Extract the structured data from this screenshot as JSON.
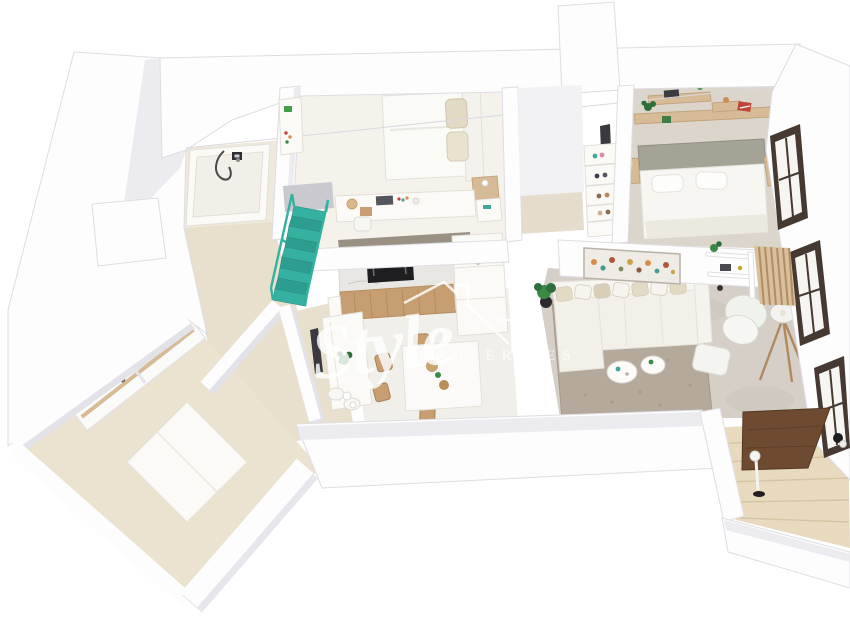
{
  "watermark": {
    "brand": "Style",
    "subtitle": "PROPERTIES",
    "color": "#ffffff",
    "opacity": "0.82"
  },
  "colors": {
    "background": "#ffffff",
    "wall_white": "#fdfdfd",
    "wall_shade": "#e7e7ed",
    "floor_bathroom": "#efe9dc",
    "floor_bedroom1": "#f5f2ec",
    "floor_bedroom2": "#dbd5cc",
    "floor_hall": "#e9dfcd",
    "floor_kitchen": "#e8decd",
    "floor_dining": "#f1efe9",
    "floor_living": "#d5cfc7",
    "floor_storage": "#ece2d0",
    "floor_closet": "#e6dccb",
    "terrace_deck": "#e7dabe",
    "terrace_table_brown": "#6e4a31",
    "rug": "#b5a99b",
    "stairs_teal": "#35b1a2",
    "stairs_teal_dark": "#2c9d8f",
    "wood": "#c79e72",
    "wood_light": "#d7bb96",
    "marble": "#e9e7e3",
    "appliance_black": "#1e1d20",
    "headboard_sage": "#a5a296",
    "sofa_cream": "#f3f0ea",
    "pillow_beige": "#e3dac5",
    "plant_green": "#3a8a46",
    "plant_dark": "#2e6e3a",
    "accent_red": "#c14538",
    "accent_teal": "#3fa79b",
    "accent_orange": "#d98c4a",
    "window_frame": "#453931",
    "door_dark": "#3a3a3e",
    "lamp_glow": "#ffc98e",
    "sign_green": "#43a047"
  },
  "scene": {
    "type": "isometric-3d-floor-plan-render",
    "rooms": [
      {
        "name": "bathroom",
        "items": [
          "bathtub",
          "shower-hose",
          "wall-mixer"
        ]
      },
      {
        "name": "bedroom-1",
        "items": [
          "double-bed",
          "beige-pillows",
          "headboard",
          "nightstand",
          "desk",
          "desk-accessories",
          "desk-chair",
          "hall-cabinet"
        ]
      },
      {
        "name": "hall-closet",
        "items": [
          "built-in-wardrobe",
          "shoe-shelf",
          "entry-door"
        ]
      },
      {
        "name": "bedroom-2",
        "items": [
          "double-bed",
          "sage-headboard",
          "white-pillows",
          "bedside-tables",
          "glowing-lamps",
          "floating-wood-shelves",
          "books",
          "plants"
        ]
      },
      {
        "name": "kitchen",
        "items": [
          "marble-backsplash",
          "built-in-oven",
          "wood-base-cabinets",
          "tall-units",
          "counter-plant",
          "peninsula",
          "bar-stools"
        ]
      },
      {
        "name": "dining-area",
        "items": [
          "dining-table",
          "wood-chairs",
          "decor-bowls",
          "floor-plant",
          "vases"
        ]
      },
      {
        "name": "living-room",
        "items": [
          "corner-sofa",
          "cushions",
          "area-rug",
          "round-coffee-tables",
          "armchair",
          "ottoman",
          "tripod-floor-lamp",
          "wall-art",
          "wall-shelves",
          "wood-slat-panel",
          "potted-plant"
        ]
      },
      {
        "name": "hallway",
        "items": [
          "teal-staircase",
          "teal-railing",
          "doorways"
        ]
      },
      {
        "name": "storage-room",
        "items": [
          "wood-shelving-unit",
          "platform-bed"
        ]
      },
      {
        "name": "terrace",
        "items": [
          "wood-decking",
          "dark-wood-table",
          "outdoor-floor-lamp",
          "outdoor-chair"
        ]
      },
      {
        "name": "facade",
        "items": [
          "window",
          "window",
          "window",
          "entry-vestibule"
        ]
      }
    ]
  }
}
